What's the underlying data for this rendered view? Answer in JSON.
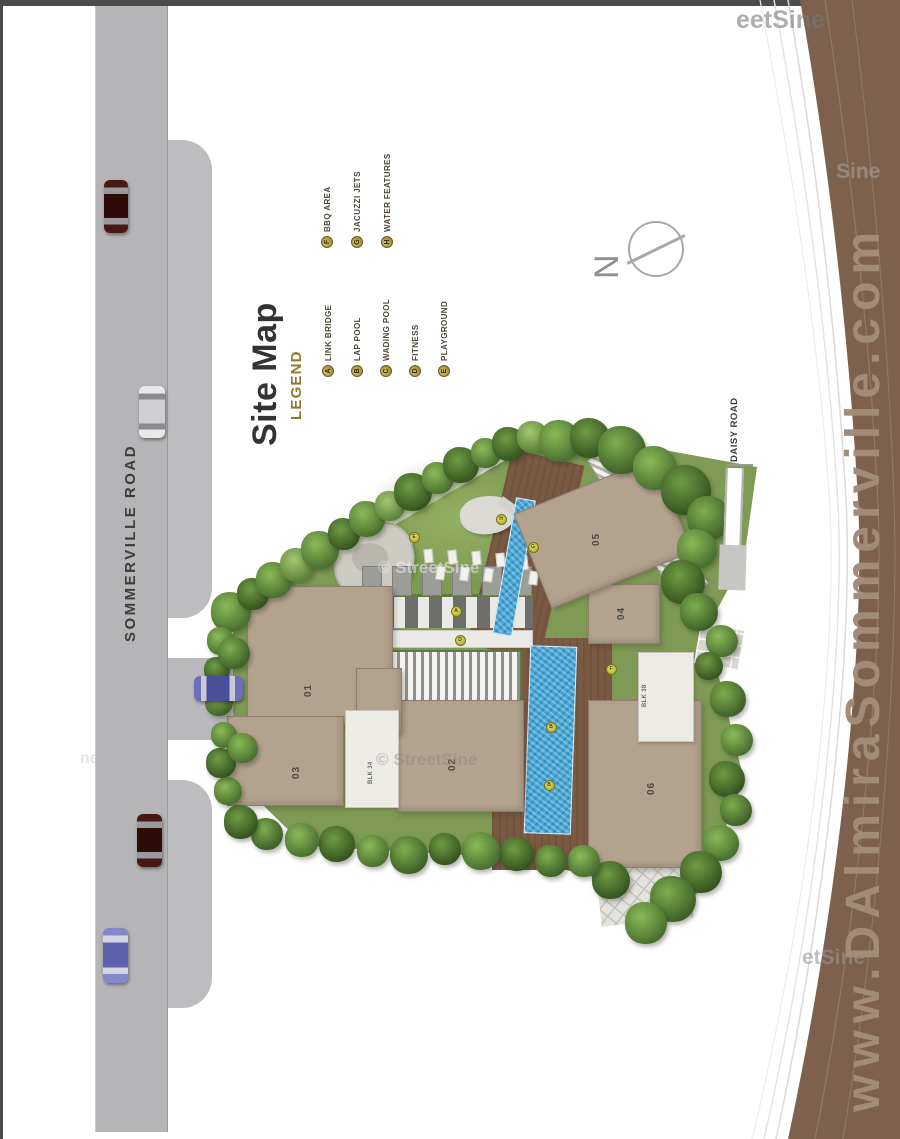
{
  "page": {
    "top_bar_color": "#4b4b4b",
    "road_color": "#b5b5b8"
  },
  "title_block": {
    "title": "Site Map",
    "legend_heading": "LEGEND"
  },
  "legend": {
    "columns": [
      {
        "x0": 328,
        "dx": 29,
        "anchor_y": 377,
        "items": [
          {
            "letter": "A",
            "label": "LINK BRIDGE"
          },
          {
            "letter": "B",
            "label": "LAP POOL"
          },
          {
            "letter": "C",
            "label": "WADING POOL"
          },
          {
            "letter": "D",
            "label": "FITNESS"
          },
          {
            "letter": "E",
            "label": "PLAYGROUND"
          }
        ]
      },
      {
        "x0": 327,
        "dx": 30,
        "anchor_y": 248,
        "items": [
          {
            "letter": "F",
            "label": "BBQ AREA"
          },
          {
            "letter": "G",
            "label": "JACUZZI JETS"
          },
          {
            "letter": "H",
            "label": "WATER FEATURES"
          }
        ]
      }
    ],
    "marker_color": "#8e772b",
    "text_color": "#4c463a",
    "heading_color": "#8f7a2e"
  },
  "roads": {
    "sommerville": {
      "label": "SOMMERVILLE ROAD"
    },
    "daisy": {
      "label": "DAISY ROAD"
    }
  },
  "compass": {
    "label": "N"
  },
  "banner": {
    "url_text": "www.DAlmiraSommerville.com",
    "band_color": "#7d614c",
    "text_color": "#a28c77"
  },
  "watermarks": [
    {
      "text": "eetSine",
      "x": 736,
      "y": 6,
      "size": 25,
      "color": "rgba(120,120,120,0.6)"
    },
    {
      "text": "Sine",
      "x": 836,
      "y": 160,
      "size": 21,
      "color": "rgba(158,158,158,0.65)"
    },
    {
      "text": "© StreetSine",
      "x": 378,
      "y": 558,
      "size": 17,
      "color": "rgba(240,240,240,0.55)"
    },
    {
      "text": "© StreetSine",
      "x": 376,
      "y": 750,
      "size": 17,
      "color": "rgba(130,130,130,0.4)"
    },
    {
      "text": "etSine",
      "x": 802,
      "y": 946,
      "size": 21,
      "color": "rgba(150,150,150,0.6)"
    },
    {
      "text": "ne",
      "x": 80,
      "y": 750,
      "size": 16,
      "color": "rgba(190,190,190,0.45)"
    }
  ],
  "site": {
    "buildings": [
      {
        "id": "01",
        "x": 247,
        "y": 586,
        "w": 146,
        "h": 140,
        "rot": 0,
        "lx": 308,
        "ly": 688
      },
      {
        "id": "02",
        "x": 396,
        "y": 700,
        "w": 128,
        "h": 112,
        "rot": 0,
        "lx": 452,
        "ly": 762
      },
      {
        "id": "03",
        "x": 227,
        "y": 716,
        "w": 117,
        "h": 90,
        "rot": 0,
        "lx": 296,
        "ly": 770
      },
      {
        "id": "04",
        "x": 588,
        "y": 584,
        "w": 72,
        "h": 60,
        "rot": 0,
        "lx": 621,
        "ly": 611
      },
      {
        "id": "05",
        "x": 527,
        "y": 482,
        "w": 152,
        "h": 102,
        "rot": -22,
        "lx": 596,
        "ly": 537
      },
      {
        "id": "06",
        "x": 588,
        "y": 700,
        "w": 114,
        "h": 168,
        "rot": 0,
        "lx": 651,
        "ly": 786
      },
      {
        "id": "",
        "x": 356,
        "y": 668,
        "w": 46,
        "h": 66,
        "rot": 0,
        "lx": 0,
        "ly": 0
      }
    ],
    "blocks": [
      {
        "label": "BLK 34",
        "x": 345,
        "y": 710,
        "w": 54,
        "h": 98,
        "lx": 371,
        "ly": 773
      },
      {
        "label": "BLK 38",
        "x": 638,
        "y": 652,
        "w": 56,
        "h": 90,
        "lx": 645,
        "ly": 696
      }
    ],
    "markers": [
      {
        "x": 414,
        "y": 537,
        "letter": "E"
      },
      {
        "x": 501,
        "y": 519,
        "letter": "H"
      },
      {
        "x": 533,
        "y": 547,
        "letter": "G"
      },
      {
        "x": 456,
        "y": 611,
        "letter": "A"
      },
      {
        "x": 460,
        "y": 640,
        "letter": "D"
      },
      {
        "x": 611,
        "y": 669,
        "letter": "F"
      },
      {
        "x": 551,
        "y": 727,
        "letter": "B"
      },
      {
        "x": 549,
        "y": 785,
        "letter": "B"
      }
    ],
    "cars": [
      {
        "name": "car-dark-red-top",
        "x": 104,
        "y": 180,
        "w": 24,
        "h": 53,
        "dir": "v",
        "body": "#4a1812",
        "roof": "#2e0d09",
        "win": "#9a9aa0"
      },
      {
        "name": "car-white",
        "x": 139,
        "y": 386,
        "w": 26,
        "h": 52,
        "dir": "v",
        "body": "#e9e9ea",
        "roof": "#cfcfd2",
        "win": "#8a8a90"
      },
      {
        "name": "car-blue-driveway",
        "x": 194,
        "y": 676,
        "w": 49,
        "h": 25,
        "dir": "h",
        "body": "#6b6fb8",
        "roof": "#4a4f9a",
        "win": "#c9c9d6"
      },
      {
        "name": "car-dark-red-bottom",
        "x": 137,
        "y": 814,
        "w": 25,
        "h": 53,
        "dir": "v",
        "body": "#4a1812",
        "roof": "#2e0d09",
        "win": "#9a9aa0"
      },
      {
        "name": "car-blue-bottom",
        "x": 103,
        "y": 928,
        "w": 25,
        "h": 55,
        "dir": "v",
        "body": "#8289c8",
        "roof": "#5d64ad",
        "win": "#d6d6e2"
      }
    ],
    "trees": [
      [
        231,
        612,
        20,
        1
      ],
      [
        253,
        594,
        16,
        2
      ],
      [
        274,
        580,
        18,
        1
      ],
      [
        297,
        565,
        17,
        3
      ],
      [
        320,
        550,
        19,
        1
      ],
      [
        344,
        534,
        16,
        2
      ],
      [
        367,
        519,
        18,
        1
      ],
      [
        390,
        506,
        15,
        3
      ],
      [
        413,
        492,
        19,
        2
      ],
      [
        438,
        478,
        16,
        1
      ],
      [
        461,
        465,
        18,
        2
      ],
      [
        486,
        453,
        15,
        1
      ],
      [
        509,
        444,
        17,
        2
      ],
      [
        533,
        437,
        16,
        3
      ],
      [
        560,
        441,
        21,
        1
      ],
      [
        590,
        438,
        20,
        2
      ],
      [
        622,
        450,
        24,
        0
      ],
      [
        655,
        468,
        22,
        1
      ],
      [
        686,
        490,
        25,
        2
      ],
      [
        709,
        518,
        22,
        0
      ],
      [
        697,
        549,
        20,
        1
      ],
      [
        683,
        582,
        22,
        2
      ],
      [
        699,
        612,
        19,
        0
      ],
      [
        722,
        641,
        16,
        1
      ],
      [
        709,
        666,
        14,
        2
      ],
      [
        728,
        699,
        18,
        0
      ],
      [
        737,
        740,
        16,
        1
      ],
      [
        727,
        779,
        18,
        2
      ],
      [
        736,
        810,
        16,
        0
      ],
      [
        721,
        843,
        18,
        1
      ],
      [
        701,
        872,
        21,
        2
      ],
      [
        673,
        899,
        23,
        0
      ],
      [
        646,
        923,
        21,
        1
      ],
      [
        611,
        880,
        19,
        2
      ],
      [
        584,
        861,
        16,
        1
      ],
      [
        551,
        861,
        16,
        0
      ],
      [
        517,
        854,
        17,
        2
      ],
      [
        481,
        851,
        19,
        1
      ],
      [
        445,
        849,
        16,
        2
      ],
      [
        409,
        855,
        19,
        0
      ],
      [
        373,
        851,
        16,
        1
      ],
      [
        337,
        844,
        18,
        2
      ],
      [
        302,
        840,
        17,
        1
      ],
      [
        267,
        834,
        16,
        0
      ],
      [
        241,
        822,
        17,
        2
      ],
      [
        228,
        791,
        14,
        1
      ],
      [
        221,
        763,
        15,
        2
      ],
      [
        224,
        735,
        13,
        1
      ],
      [
        219,
        702,
        14,
        0
      ],
      [
        217,
        670,
        13,
        2
      ],
      [
        221,
        641,
        14,
        1
      ],
      [
        234,
        653,
        16,
        0
      ],
      [
        243,
        748,
        15,
        1
      ]
    ]
  }
}
